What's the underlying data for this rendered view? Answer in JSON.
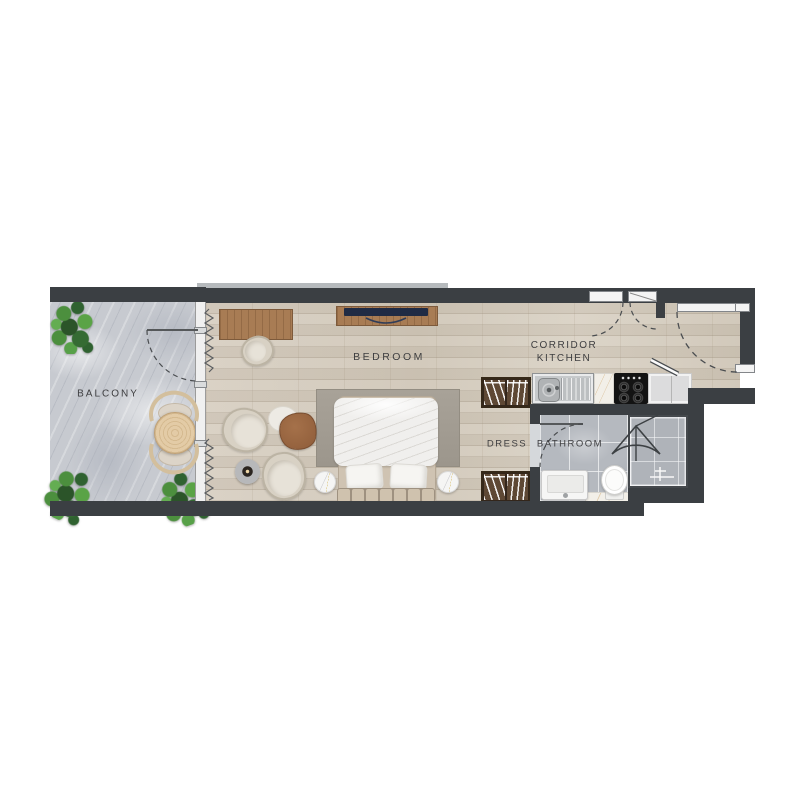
{
  "plan": {
    "type": "apartment-floor-plan",
    "rooms": {
      "balcony": {
        "label": "BALCONY"
      },
      "bedroom": {
        "label": "BEDROOM"
      },
      "corridor_kitchen": {
        "label_line1": "CORRIDOR",
        "label_line2": "KITCHEN"
      },
      "dress": {
        "label": "DRESS"
      },
      "bathroom": {
        "label": "BATHROOM"
      }
    },
    "colors": {
      "wall": "#3b3f43",
      "wood_floor": "#d5ccbf",
      "stone_floor": "#c7cad0",
      "tile_floor": "#b5b9bf",
      "rug": "#a29c92",
      "wardrobe_wood": "#5e4834",
      "counter_steel": "#c6c9cb",
      "stove_black": "#131313",
      "plant_green": "#4c8f3e",
      "furniture_beige": "#d8d1c4",
      "accent_wood": "#a87c54",
      "label_text": "#3e3e40"
    },
    "icons": [
      "plant-icon",
      "dining-table-icon",
      "balcony-chair-icon",
      "door-swing-icon",
      "window-wall-icon",
      "curtain-icon",
      "desk-icon",
      "desk-chair-icon",
      "tv-console-icon",
      "tv-icon",
      "rug-icon",
      "bed-icon",
      "pillow-icon",
      "headboard-icon",
      "nightstand-icon",
      "armchair-icon",
      "side-table-icon",
      "candle-table-icon",
      "wardrobe-icon",
      "kitchen-sink-icon",
      "stove-icon",
      "counter-icon",
      "bathroom-sink-icon",
      "toilet-icon",
      "shower-icon",
      "shower-valve-icon"
    ]
  }
}
